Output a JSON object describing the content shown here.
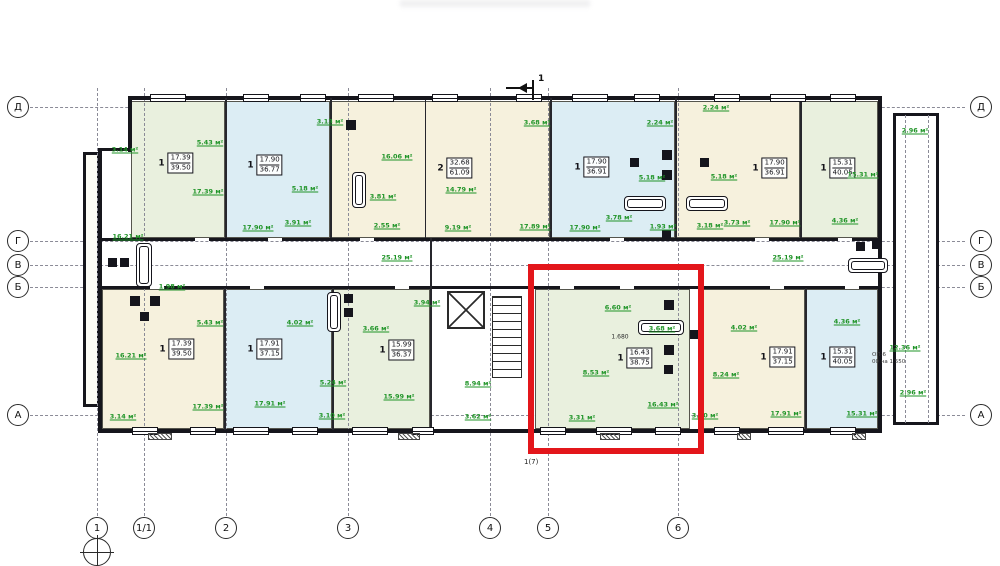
{
  "texts": {
    "section_mark": "1",
    "stair_mark": "1(7)",
    "window_spec_1": "ОП-6",
    "window_spec_2": "00 на 1 550",
    "dimension": "1.680"
  },
  "colors": {
    "highlight_red": "#e3161b",
    "area_label_green": "#1f9427",
    "fill_cream": "#f6f1dd",
    "fill_blue": "#dcedf4",
    "fill_green": "#e9f0de",
    "wall": "#16161c"
  },
  "plan": {
    "axes": {
      "rows": [
        {
          "label": "Д",
          "y": 107
        },
        {
          "label": "Г",
          "y": 241
        },
        {
          "label": "В",
          "y": 265
        },
        {
          "label": "Б",
          "y": 287
        },
        {
          "label": "А",
          "y": 415
        }
      ],
      "cols": [
        {
          "label": "1",
          "x": 97,
          "benchmark": true
        },
        {
          "label": "1/1",
          "x": 144
        },
        {
          "label": "2",
          "x": 226
        },
        {
          "label": "3",
          "x": 348
        },
        {
          "label": "4",
          "x": 490
        },
        {
          "label": "5",
          "x": 548
        },
        {
          "label": "6",
          "x": 678
        }
      ]
    },
    "apartments": [
      {
        "rooms": "1",
        "living": "17.39",
        "total": "39.50",
        "fill": "green",
        "rect": [
          131,
          101,
          94,
          137
        ],
        "label": [
          176,
          163
        ],
        "highlighted": false
      },
      {
        "rooms": "1",
        "living": "17.90",
        "total": "36.77",
        "fill": "blue",
        "rect": [
          225,
          101,
          105,
          137
        ],
        "label": [
          265,
          165
        ],
        "highlighted": false
      },
      {
        "rooms": "2",
        "living": "32.68",
        "total": "61.09",
        "fill": "cream",
        "rect": [
          330,
          101,
          220,
          137
        ],
        "label": [
          455,
          168
        ],
        "highlighted": false
      },
      {
        "rooms": "1",
        "living": "17.90",
        "total": "36.91",
        "fill": "blue",
        "rect": [
          550,
          101,
          125,
          137
        ],
        "label": [
          592,
          167
        ],
        "highlighted": false
      },
      {
        "rooms": "1",
        "living": "17.90",
        "total": "36.91",
        "fill": "cream",
        "rect": [
          675,
          101,
          125,
          137
        ],
        "label": [
          770,
          168
        ],
        "highlighted": false
      },
      {
        "rooms": "1",
        "living": "15.31",
        "total": "40.05",
        "fill": "green",
        "rect": [
          800,
          101,
          78,
          137
        ],
        "label": [
          838,
          168
        ],
        "highlighted": false
      },
      {
        "rooms": "1",
        "living": "17.39",
        "total": "39.50",
        "fill": "cream",
        "rect": [
          102,
          289,
          122,
          140
        ],
        "label": [
          177,
          349
        ],
        "highlighted": false
      },
      {
        "rooms": "1",
        "living": "17.91",
        "total": "37.15",
        "fill": "blue",
        "rect": [
          224,
          289,
          108,
          140
        ],
        "label": [
          265,
          349
        ],
        "highlighted": false
      },
      {
        "rooms": "1",
        "living": "15.99",
        "total": "36.37",
        "fill": "green",
        "rect": [
          332,
          289,
          98,
          140
        ],
        "label": [
          397,
          350
        ],
        "highlighted": false
      },
      {
        "rooms": "1",
        "living": "16.43",
        "total": "38.75",
        "fill": "green",
        "rect": [
          535,
          289,
          155,
          140
        ],
        "label": [
          635,
          358
        ],
        "highlighted": true
      },
      {
        "rooms": "1",
        "living": "17.91",
        "total": "37.15",
        "fill": "cream",
        "rect": [
          700,
          289,
          105,
          140
        ],
        "label": [
          778,
          357
        ],
        "highlighted": false
      },
      {
        "rooms": "1",
        "living": "15.31",
        "total": "40.05",
        "fill": "blue",
        "rect": [
          805,
          289,
          73,
          140
        ],
        "label": [
          838,
          357
        ],
        "highlighted": false
      }
    ],
    "room_labels": [
      {
        "t": "3.14 м²",
        "x": 125,
        "y": 150
      },
      {
        "t": "17.39 м²",
        "x": 208,
        "y": 192
      },
      {
        "t": "5.43 м²",
        "x": 210,
        "y": 143
      },
      {
        "t": "16.21 м²",
        "x": 128,
        "y": 237
      },
      {
        "t": "17.90 м²",
        "x": 258,
        "y": 228
      },
      {
        "t": "3.13 м²",
        "x": 330,
        "y": 122
      },
      {
        "t": "5.18 м²",
        "x": 305,
        "y": 189
      },
      {
        "t": "3.91 м²",
        "x": 298,
        "y": 223
      },
      {
        "t": "16.06 м²",
        "x": 397,
        "y": 157
      },
      {
        "t": "14.79 м²",
        "x": 461,
        "y": 190
      },
      {
        "t": "3.81 м²",
        "x": 383,
        "y": 197
      },
      {
        "t": "2.55 м²",
        "x": 387,
        "y": 226
      },
      {
        "t": "9.19 м²",
        "x": 458,
        "y": 228
      },
      {
        "t": "17.89 м²",
        "x": 535,
        "y": 227
      },
      {
        "t": "3.68 м²",
        "x": 537,
        "y": 123
      },
      {
        "t": "17.90 м²",
        "x": 585,
        "y": 228
      },
      {
        "t": "2.24 м²",
        "x": 660,
        "y": 123
      },
      {
        "t": "2.24 м²",
        "x": 716,
        "y": 108
      },
      {
        "t": "5.18 м²",
        "x": 652,
        "y": 178
      },
      {
        "t": "5.18 м²",
        "x": 724,
        "y": 177
      },
      {
        "t": "3.78 м²",
        "x": 619,
        "y": 218
      },
      {
        "t": "1.93 м²",
        "x": 663,
        "y": 227
      },
      {
        "t": "3.18 м²",
        "x": 710,
        "y": 226
      },
      {
        "t": "3.73 м²",
        "x": 737,
        "y": 223
      },
      {
        "t": "17.90 м²",
        "x": 785,
        "y": 223
      },
      {
        "t": "2.96 м²",
        "x": 915,
        "y": 131
      },
      {
        "t": "15.31 м²",
        "x": 863,
        "y": 175
      },
      {
        "t": "4.36 м²",
        "x": 845,
        "y": 221
      },
      {
        "t": "25.19 м²",
        "x": 397,
        "y": 258
      },
      {
        "t": "25.19 м²",
        "x": 788,
        "y": 258
      },
      {
        "t": "1.98 м²",
        "x": 172,
        "y": 287
      },
      {
        "t": "5.43 м²",
        "x": 210,
        "y": 323
      },
      {
        "t": "16.21 м²",
        "x": 131,
        "y": 356
      },
      {
        "t": "17.39 м²",
        "x": 208,
        "y": 407
      },
      {
        "t": "3.14 м²",
        "x": 123,
        "y": 417
      },
      {
        "t": "17.91 м²",
        "x": 270,
        "y": 404
      },
      {
        "t": "4.02 м²",
        "x": 300,
        "y": 323
      },
      {
        "t": "5.24 м²",
        "x": 333,
        "y": 383
      },
      {
        "t": "3.10 м²",
        "x": 332,
        "y": 416
      },
      {
        "t": "3.66 м²",
        "x": 376,
        "y": 329
      },
      {
        "t": "3.94 м²",
        "x": 427,
        "y": 303
      },
      {
        "t": "15.99 м²",
        "x": 399,
        "y": 397
      },
      {
        "t": "8.94 м²",
        "x": 478,
        "y": 384
      },
      {
        "t": "3.62 м²",
        "x": 478,
        "y": 417
      },
      {
        "t": "6.60 м²",
        "x": 618,
        "y": 308
      },
      {
        "t": "3.68 м²",
        "x": 662,
        "y": 329
      },
      {
        "t": "8.53 м²",
        "x": 596,
        "y": 373
      },
      {
        "t": "16.43 м²",
        "x": 663,
        "y": 405
      },
      {
        "t": "3.31 м²",
        "x": 582,
        "y": 418
      },
      {
        "t": "4.02 м²",
        "x": 744,
        "y": 328
      },
      {
        "t": "8.24 м²",
        "x": 726,
        "y": 375
      },
      {
        "t": "3.10 м²",
        "x": 705,
        "y": 416
      },
      {
        "t": "17.91 м²",
        "x": 786,
        "y": 414
      },
      {
        "t": "4.36 м²",
        "x": 847,
        "y": 322
      },
      {
        "t": "15.31 м²",
        "x": 862,
        "y": 414
      },
      {
        "t": "12.36 м²",
        "x": 905,
        "y": 348
      },
      {
        "t": "2.96 м²",
        "x": 913,
        "y": 393
      }
    ],
    "black_labels": [
      {
        "t": "1.680",
        "x": 620,
        "y": 337
      }
    ],
    "highlight": {
      "x": 528,
      "y": 264,
      "w": 176,
      "h": 190
    },
    "geometry": {
      "building": [
        98,
        96,
        784,
        337
      ],
      "wing": [
        893,
        113,
        46,
        312
      ],
      "annex": [
        83,
        152,
        17,
        255
      ],
      "wing_lines": [
        905,
        928
      ],
      "walls": [
        [
          128,
          96,
          754,
          4
        ],
        [
          878,
          96,
          4,
          337
        ],
        [
          98,
          429,
          784,
          4
        ],
        [
          98,
          148,
          4,
          285
        ],
        [
          98,
          148,
          34,
          3
        ],
        [
          128,
          96,
          4,
          56
        ],
        [
          100,
          238,
          778,
          3
        ],
        [
          100,
          286,
          778,
          3
        ]
      ],
      "partitions": [
        [
          225,
          98,
          2,
          140
        ],
        [
          330,
          98,
          2,
          140
        ],
        [
          550,
          98,
          2,
          140
        ],
        [
          675,
          98,
          2,
          140
        ],
        [
          800,
          98,
          2,
          140
        ],
        [
          425,
          100,
          1,
          138
        ],
        [
          224,
          288,
          2,
          142
        ],
        [
          332,
          288,
          2,
          142
        ],
        [
          430,
          238,
          2,
          193
        ],
        [
          700,
          288,
          2,
          142
        ],
        [
          805,
          288,
          2,
          142
        ]
      ],
      "gaps": [
        [
          195,
          238,
          14,
          3
        ],
        [
          268,
          238,
          14,
          3
        ],
        [
          360,
          238,
          14,
          3
        ],
        [
          610,
          238,
          14,
          3
        ],
        [
          755,
          238,
          14,
          3
        ],
        [
          838,
          238,
          14,
          3
        ],
        [
          150,
          286,
          14,
          3
        ],
        [
          250,
          286,
          14,
          3
        ],
        [
          395,
          286,
          14,
          3
        ],
        [
          560,
          286,
          14,
          3
        ],
        [
          620,
          286,
          14,
          3
        ],
        [
          770,
          286,
          14,
          3
        ],
        [
          845,
          286,
          14,
          3
        ]
      ],
      "windows_top": [
        [
          150,
          36
        ],
        [
          243,
          26
        ],
        [
          300,
          26
        ],
        [
          358,
          36
        ],
        [
          432,
          26
        ],
        [
          516,
          26
        ],
        [
          572,
          36
        ],
        [
          634,
          26
        ],
        [
          714,
          26
        ],
        [
          770,
          36
        ],
        [
          830,
          26
        ]
      ],
      "windows_bottom": [
        [
          132,
          26
        ],
        [
          190,
          26
        ],
        [
          233,
          36
        ],
        [
          292,
          26
        ],
        [
          352,
          36
        ],
        [
          412,
          22
        ],
        [
          540,
          26
        ],
        [
          596,
          36
        ],
        [
          655,
          26
        ],
        [
          714,
          26
        ],
        [
          768,
          36
        ],
        [
          830,
          26
        ]
      ],
      "vents": [
        [
          148,
          433,
          24,
          7
        ],
        [
          398,
          433,
          22,
          7
        ],
        [
          600,
          433,
          20,
          7
        ],
        [
          737,
          433,
          14,
          7
        ],
        [
          852,
          433,
          14,
          7
        ]
      ],
      "elevator": [
        447,
        291,
        38,
        38
      ],
      "stairs": [
        492,
        296,
        30,
        82
      ],
      "fixtures": [
        {
          "type": "tub-v",
          "x": 136,
          "y": 243,
          "w": 16,
          "h": 44
        },
        {
          "type": "sq",
          "x": 130,
          "y": 296,
          "s": 10
        },
        {
          "type": "sq",
          "x": 150,
          "y": 296,
          "s": 10
        },
        {
          "type": "sq",
          "x": 140,
          "y": 312,
          "s": 9
        },
        {
          "type": "sq",
          "x": 108,
          "y": 258,
          "s": 9
        },
        {
          "type": "sq",
          "x": 120,
          "y": 258,
          "s": 9
        },
        {
          "type": "tub-v",
          "x": 352,
          "y": 172,
          "w": 14,
          "h": 36
        },
        {
          "type": "sq",
          "x": 346,
          "y": 120,
          "s": 10
        },
        {
          "type": "tub-v",
          "x": 327,
          "y": 292,
          "w": 14,
          "h": 40
        },
        {
          "type": "sq",
          "x": 344,
          "y": 294,
          "s": 9
        },
        {
          "type": "sq",
          "x": 344,
          "y": 308,
          "s": 9
        },
        {
          "type": "tub-h",
          "x": 624,
          "y": 196,
          "w": 42,
          "h": 15
        },
        {
          "type": "tub-h",
          "x": 686,
          "y": 196,
          "w": 42,
          "h": 15
        },
        {
          "type": "sq",
          "x": 662,
          "y": 150,
          "s": 10
        },
        {
          "type": "sq",
          "x": 662,
          "y": 170,
          "s": 10
        },
        {
          "type": "sq",
          "x": 630,
          "y": 158,
          "s": 9
        },
        {
          "type": "sq",
          "x": 700,
          "y": 158,
          "s": 9
        },
        {
          "type": "sq",
          "x": 662,
          "y": 230,
          "s": 9
        },
        {
          "type": "tub-h",
          "x": 638,
          "y": 320,
          "w": 46,
          "h": 15
        },
        {
          "type": "sq",
          "x": 664,
          "y": 300,
          "s": 10
        },
        {
          "type": "sq",
          "x": 664,
          "y": 345,
          "s": 10
        },
        {
          "type": "sq",
          "x": 664,
          "y": 365,
          "s": 9
        },
        {
          "type": "sq",
          "x": 690,
          "y": 330,
          "s": 9
        },
        {
          "type": "tub-h",
          "x": 848,
          "y": 258,
          "w": 40,
          "h": 15
        },
        {
          "type": "sq",
          "x": 872,
          "y": 240,
          "s": 9
        },
        {
          "type": "sq",
          "x": 856,
          "y": 242,
          "s": 9
        }
      ]
    }
  }
}
